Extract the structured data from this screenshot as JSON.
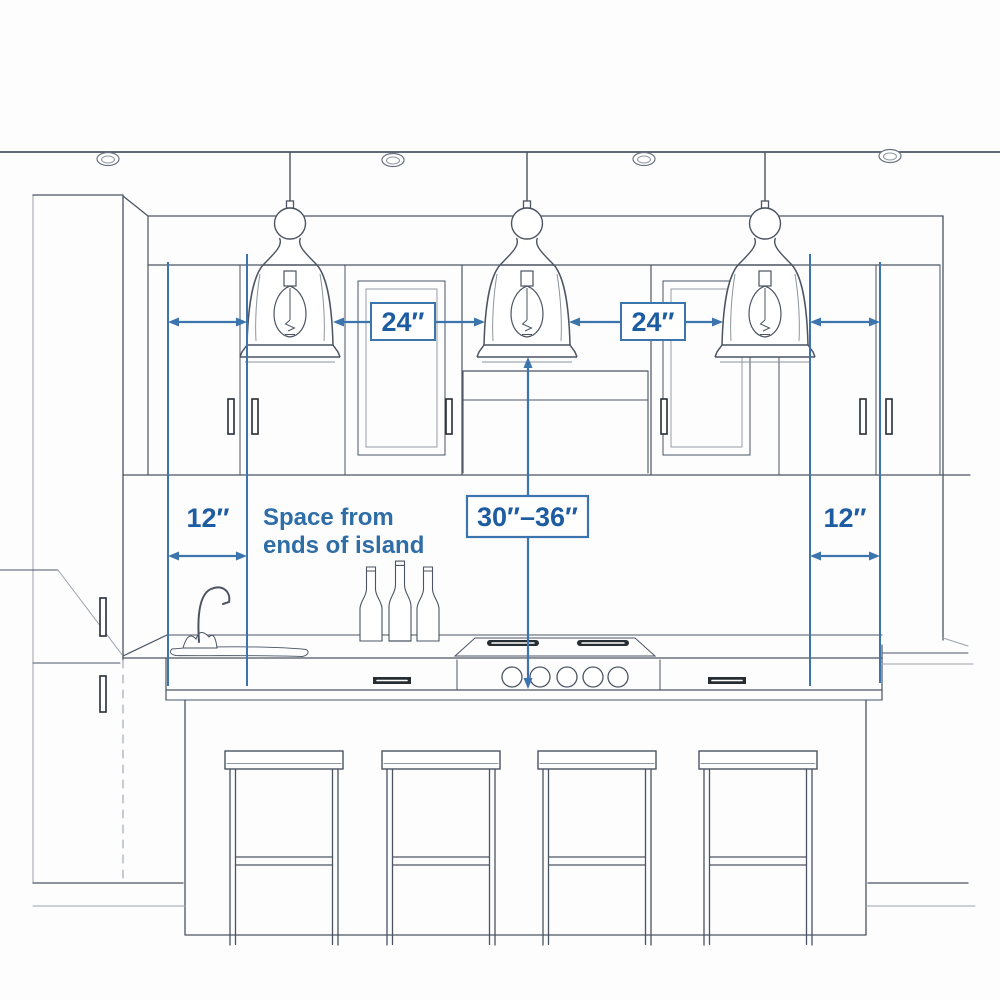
{
  "diagram": {
    "title": "Kitchen island pendant light spacing guide",
    "dimensions": {
      "pendant_spacing_left": "24″",
      "pendant_spacing_right": "24″",
      "island_end_left": "12″",
      "island_end_right": "12″",
      "height_above_counter": "30″–36″"
    },
    "note": {
      "line1": "Space from",
      "line2": "ends of island"
    },
    "scene": {
      "pendant_lights": 3,
      "recessed_ceiling_lights": 4,
      "bar_stools": 4,
      "wine_bottles": 3,
      "cooktop_knobs": 5
    },
    "colors": {
      "dimension_blue": "#3c74ae",
      "label_text_blue": "#1e5ca2",
      "note_text_blue": "#2e6da6",
      "sketch_line": "#4b5462"
    }
  }
}
